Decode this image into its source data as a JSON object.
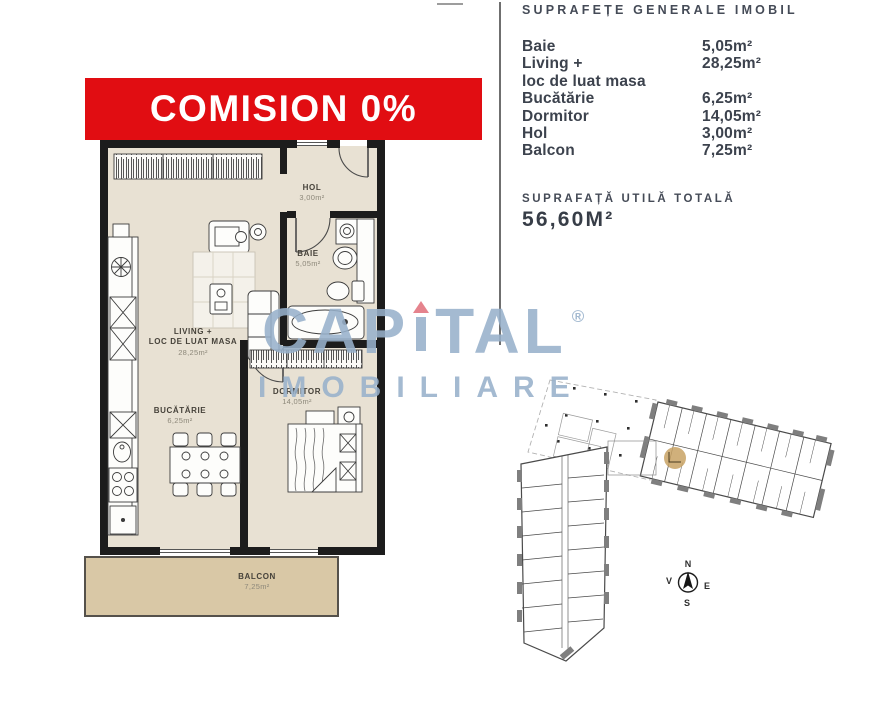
{
  "banner": {
    "text": "COMISION 0%"
  },
  "floorplan": {
    "rooms": [
      {
        "id": "hol",
        "name": "HOL",
        "area": "3,00m²"
      },
      {
        "id": "baie",
        "name": "BAIE",
        "area": "5,05m²"
      },
      {
        "id": "living",
        "name": "LIVING +",
        "name2": "LOC DE LUAT MASA",
        "area": "28,25m²"
      },
      {
        "id": "bucatarie",
        "name": "BUCĂTĂRIE",
        "area": "6,25m²"
      },
      {
        "id": "dormitor",
        "name": "DORMITOR",
        "area": "14,05m²"
      },
      {
        "id": "balcon",
        "name": "BALCON",
        "area": "7,25m²"
      }
    ]
  },
  "area_table": {
    "title": "SUPRAFEȚE GENERALE IMOBIL",
    "rows": [
      {
        "label": "Baie",
        "value": "5,05m²"
      },
      {
        "label": "Living +",
        "value": "28,25m²"
      },
      {
        "label": "loc de luat masa",
        "value": ""
      },
      {
        "label": "Bucătărie",
        "value": "6,25m²"
      },
      {
        "label": "Dormitor",
        "value": "14,05m²"
      },
      {
        "label": "Hol",
        "value": "3,00m²"
      },
      {
        "label": "Balcon",
        "value": "7,25m²"
      }
    ],
    "total_label": "SUPRAFAȚĂ UTILĂ TOTALĂ",
    "total_value": "56,60M²"
  },
  "watermark": {
    "part1": "CAP",
    "part2": "TAL",
    "registered": "®",
    "line2": "IMOBILIARE"
  },
  "compass": {
    "n": "N",
    "s": "S",
    "e": "E",
    "v": "V"
  },
  "colors": {
    "banner_red": "#e10d12",
    "floor_beige": "#e8e1d3",
    "balcony_tan": "#d9c8a6",
    "watermark_blue": "#97b1cb",
    "unit_highlight": "#c8a264",
    "wall_black": "#1c1c1c"
  }
}
